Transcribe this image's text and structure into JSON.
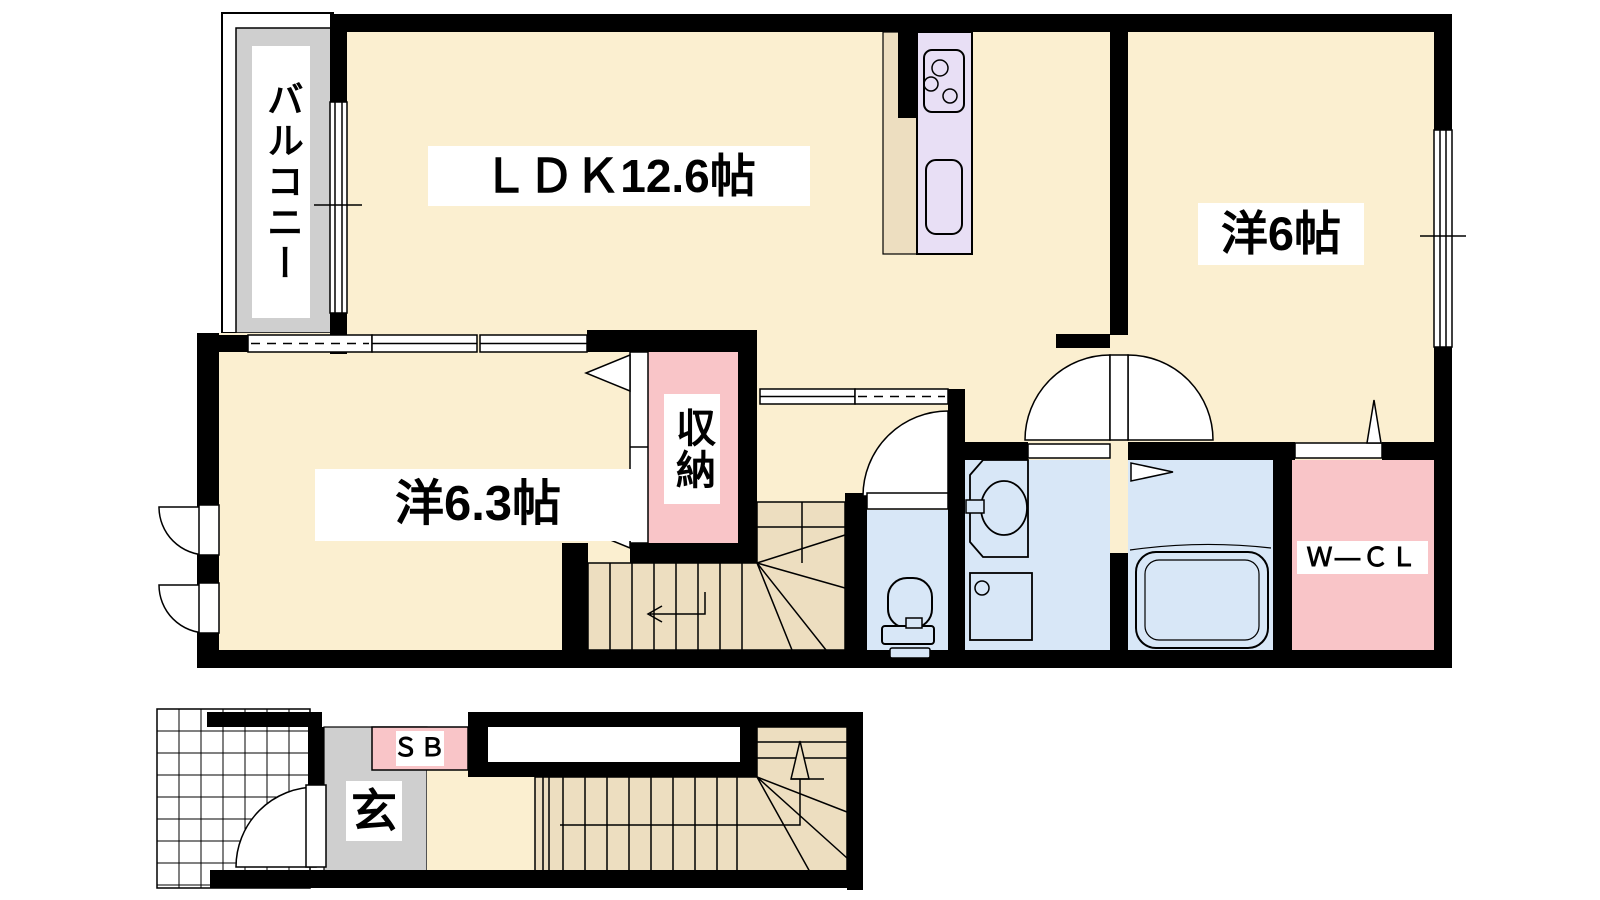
{
  "floor2": {
    "balcony": "バルコニー",
    "ldk": "ＬＤＫ12.6帖",
    "bedroom_right": "洋6帖",
    "bedroom_left": "洋6.3帖",
    "storage": "収納",
    "walk_in_closet": "Ｗ—ＣＬ"
  },
  "floor1": {
    "shoe_box": "ＳＢ",
    "entrance": "玄"
  },
  "colors": {
    "room_floor": "#FBEFD0",
    "stairs_wood": "#EDDEC0",
    "wet_area_blue": "#D8E7F7",
    "closet_pink": "#F9C5C8",
    "kitchen_counter_lavender": "#E8DFF5",
    "balcony_gray": "#CFCFCF",
    "wall_black": "#000000"
  },
  "icons": [
    "kitchen-stove-icon",
    "kitchen-sink-icon",
    "toilet-icon",
    "vanity-sink-icon",
    "washing-machine-icon",
    "bathtub-icon",
    "stairs-up-arrow-icon",
    "entrance-door-icon"
  ]
}
